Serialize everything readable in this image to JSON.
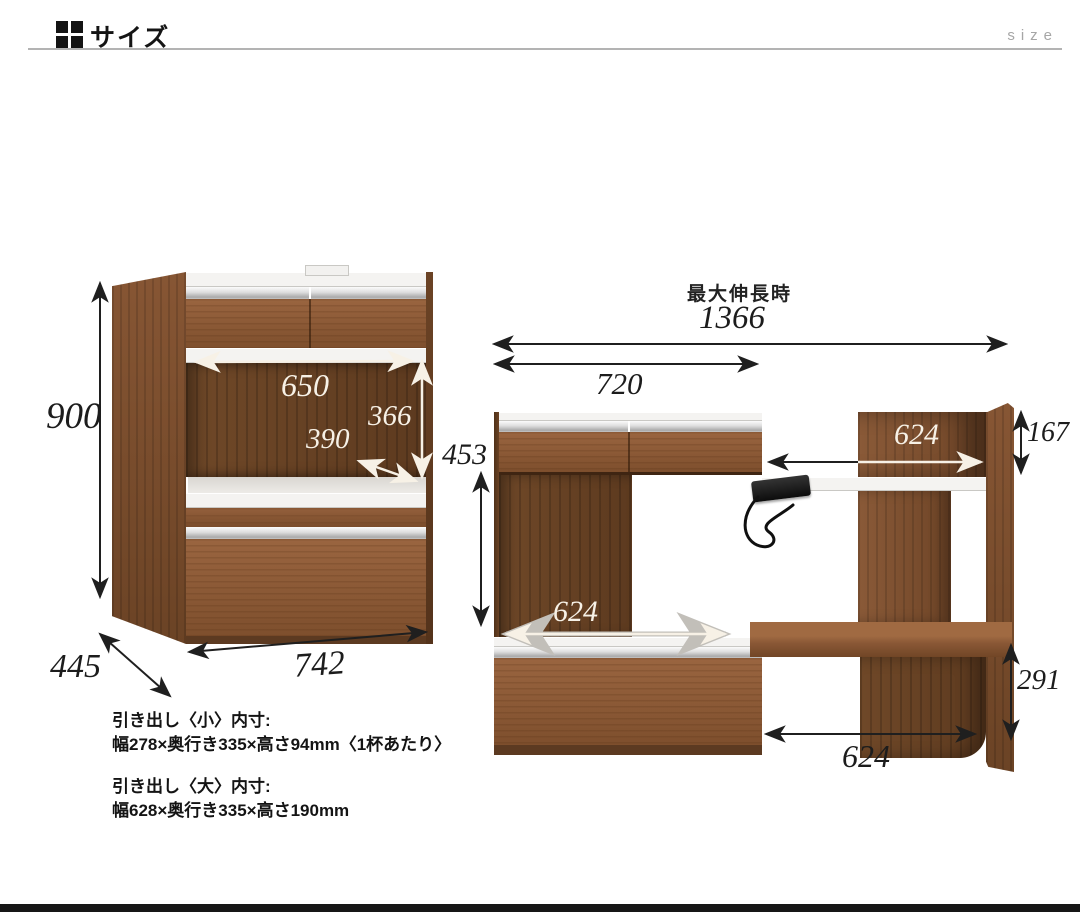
{
  "header": {
    "icon": "grid-icon",
    "title": "サイズ",
    "watermark": "size"
  },
  "closed_view": {
    "height": "900",
    "depth": "445",
    "width": "742",
    "inner_width": "650",
    "inner_height": "366",
    "inner_depth": "390"
  },
  "extended_view": {
    "max_label": "最大伸長時",
    "max_width": "1366",
    "body_width": "720",
    "left_open_height": "453",
    "top_shelf_width": "624",
    "top_right_height": "167",
    "left_inner_width": "624",
    "bottom_right_height": "291",
    "bottom_open_width": "624"
  },
  "notes": {
    "small_title": "引き出し〈小〉内寸:",
    "small_dims": "幅278×奥行き335×高さ94mm〈1杯あたり〉",
    "large_title": "引き出し〈大〉内寸:",
    "large_dims": "幅628×奥行き335×高さ190mm"
  },
  "colors": {
    "wood": "#8a5836",
    "wood_dark": "#5f3c22",
    "ink": "#1c1c1c",
    "silver": "#cccccc",
    "gray": "#a6a6a6"
  }
}
